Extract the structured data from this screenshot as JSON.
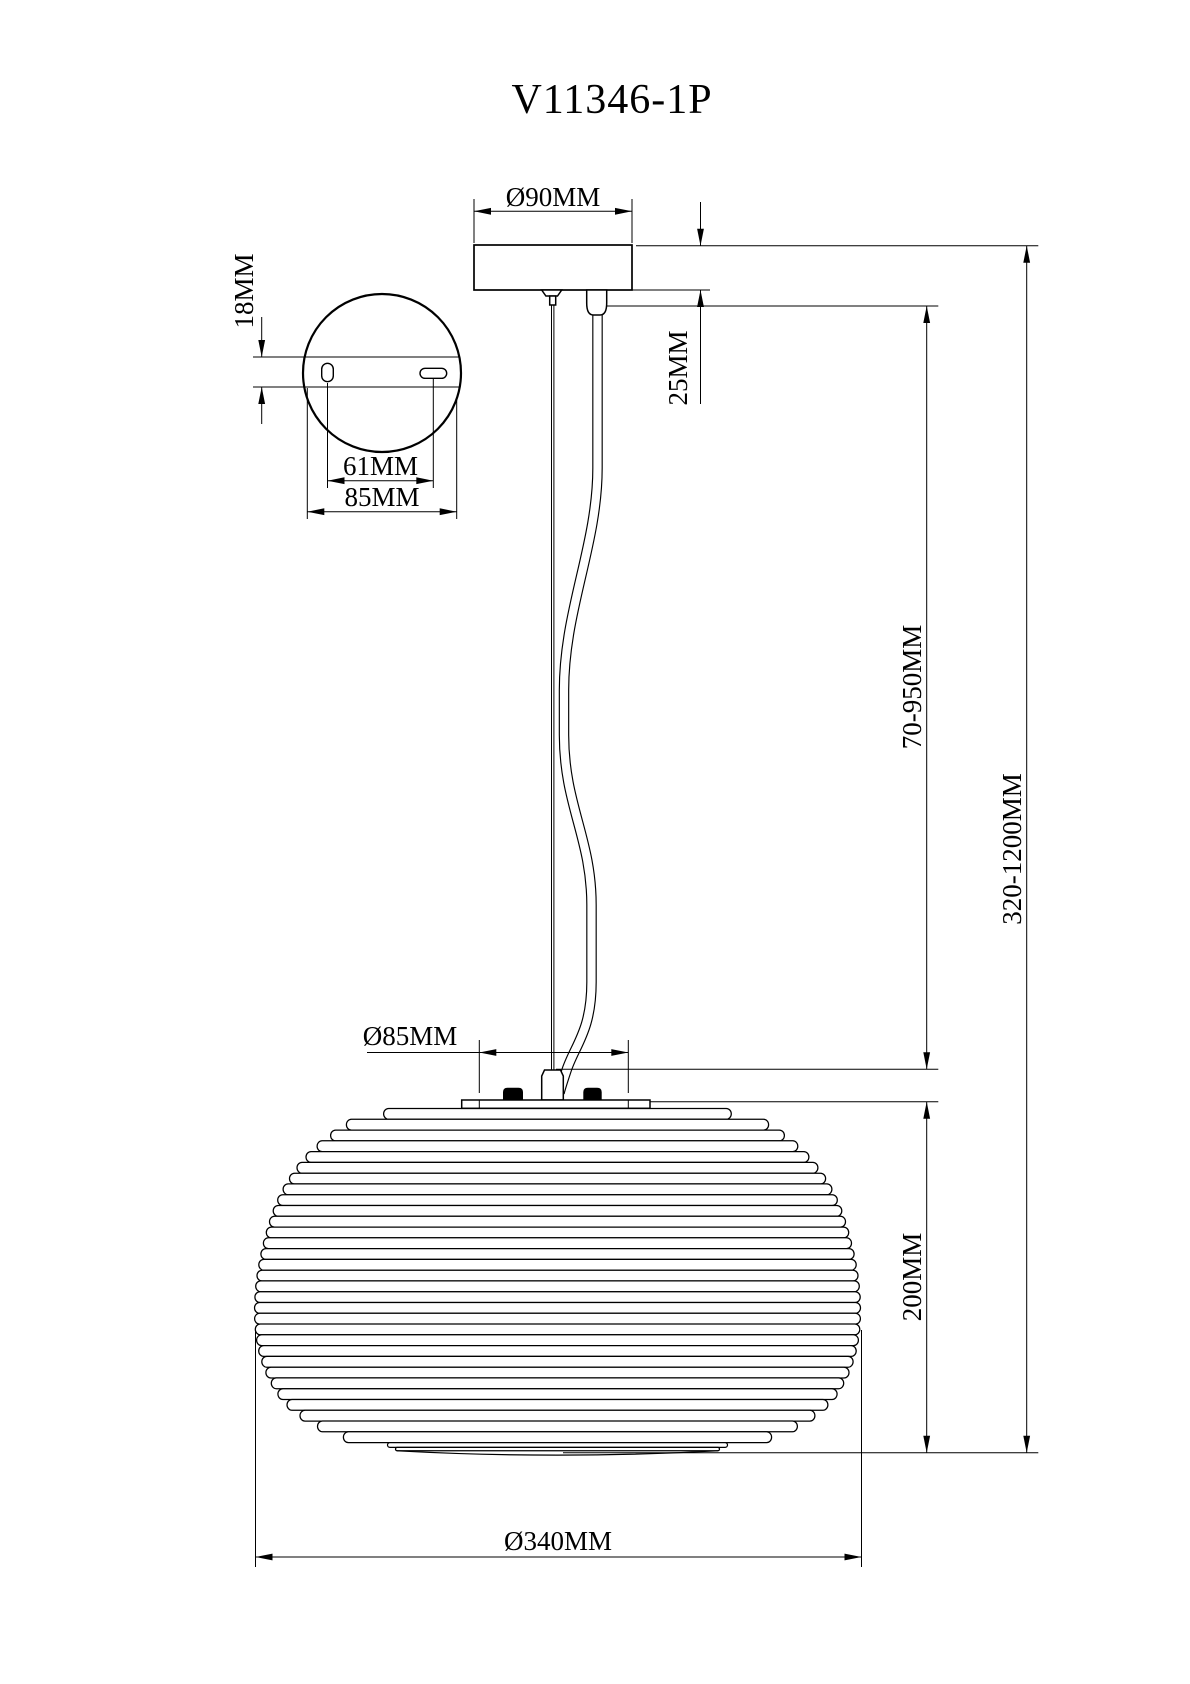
{
  "page": {
    "background": "#ffffff",
    "line_color": "#000000"
  },
  "title": "V11346-1P",
  "dimensions": {
    "canopy_diameter": "Ø90MM",
    "canopy_height": "25MM",
    "mount_plate_thickness": "18MM",
    "mount_slot_spacing": "61MM",
    "mount_plate_width": "85MM",
    "suspension_length": "70-950MM",
    "overall_height": "320-1200MM",
    "shade_fitter_diameter": "Ø85MM",
    "shade_height": "200MM",
    "shade_diameter": "Ø340MM"
  }
}
